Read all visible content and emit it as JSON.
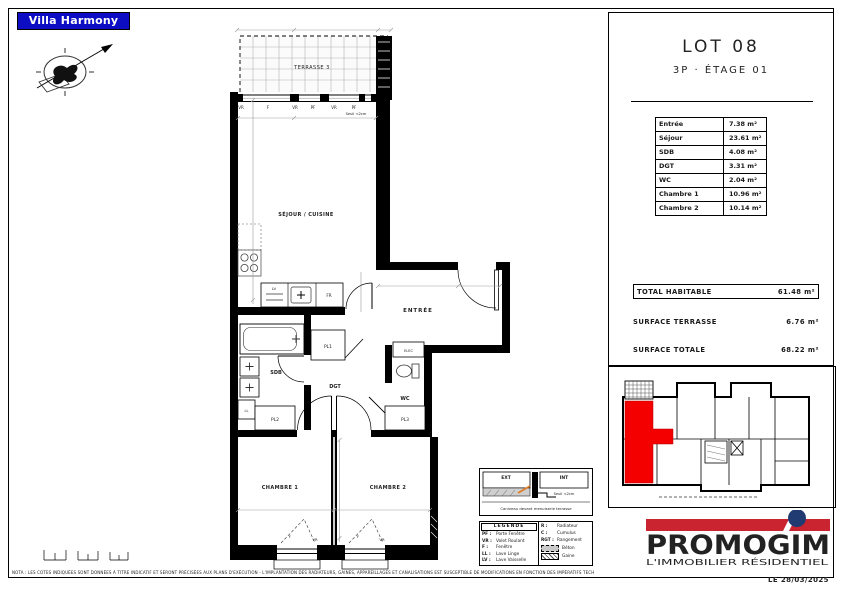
{
  "sheet": {
    "project": "Villa Harmony",
    "date": "LE 28/03/2025",
    "disclaimer": "NOTA : LES COTES INDIQUÉES SONT DONNÉES À TITRE INDICATIF ET SERONT PRÉCISÉES AUX PLANS D'EXÉCUTION - L'IMPLANTATION DES RADIATEURS, GAINES, APPAREILLAGES ET CANALISATIONS EST SUSCEPTIBLE DE MODIFICATIONS EN FONCTION DES IMPÉRATIFS TECHNIQUES DE RÉALISATION DU BÂTIMENT"
  },
  "title_block": {
    "lot": "LOT 08",
    "level": "3P · ÉTAGE 01",
    "rooms": [
      {
        "label": "Entrée",
        "value": "7.38 m²"
      },
      {
        "label": "Séjour",
        "value": "23.61 m²"
      },
      {
        "label": "SDB",
        "value": "4.08 m²"
      },
      {
        "label": "DGT",
        "value": "3.31 m²"
      },
      {
        "label": "WC",
        "value": "2.04 m²"
      },
      {
        "label": "Chambre 1",
        "value": "10.96 m²"
      },
      {
        "label": "Chambre 2",
        "value": "10.14 m²"
      }
    ],
    "total_label": "TOTAL HABITABLE",
    "total_value": "61.48 m²",
    "terrace_label": "SURFACE TERRASSE",
    "terrace_value": "6.76 m²",
    "overall_label": "SURFACE TOTALE",
    "overall_value": "68.22 m²"
  },
  "plan": {
    "labels": {
      "terrasse": "TERRASSE 3",
      "sejour": "SÉJOUR / CUISINE",
      "entree": "ENTRÉE",
      "sdb": "SDB",
      "dgt": "DGT",
      "wc": "WC",
      "elec": "ELEC",
      "pl1": "PL1",
      "pl2": "PL2",
      "pl3": "PL3",
      "chambre1": "CHAMBRE 1",
      "chambre2": "CHAMBRE 2",
      "lv": "LV",
      "fr": "FR",
      "ll": "LL"
    },
    "top_windows": [
      "VR",
      "F",
      "VR",
      "PF",
      "VR",
      "PF"
    ],
    "bottom_windows": [
      "F",
      "VR",
      "F",
      "VR"
    ],
    "seuil_note": "Seuil <2cm"
  },
  "detail_box": {
    "left": "EXT",
    "right": "INT",
    "seuil": "Seuil <2cm",
    "caption": "Caniveau devant menuiserie terrasse"
  },
  "legend": {
    "title": "LEGENDE",
    "left": [
      {
        "abbr": "PF :",
        "label": "Porte Fenêtre"
      },
      {
        "abbr": "VR :",
        "label": "Volet Roulant"
      },
      {
        "abbr": "F :",
        "label": "Fenêtre"
      },
      {
        "abbr": "LL :",
        "label": "Lave Linge"
      },
      {
        "abbr": "LV :",
        "label": "Lave Vaisselle"
      }
    ],
    "right": [
      {
        "abbr": "R :",
        "label": "Radiateur"
      },
      {
        "abbr": "C :",
        "label": "Cumulus"
      },
      {
        "abbr": "RGT :",
        "label": "Rangement"
      }
    ],
    "swatches": [
      {
        "label": "Béton"
      },
      {
        "label": "Gaine"
      }
    ]
  },
  "logo": {
    "name": "PROMOGIM",
    "tagline": "L'IMMOBILIER  RÉSIDENTIEL"
  },
  "colors": {
    "banner_blue": "#0d0dc4",
    "unit_red": "#f40000",
    "logo_red": "#c92430",
    "logo_navy": "#203a72"
  }
}
